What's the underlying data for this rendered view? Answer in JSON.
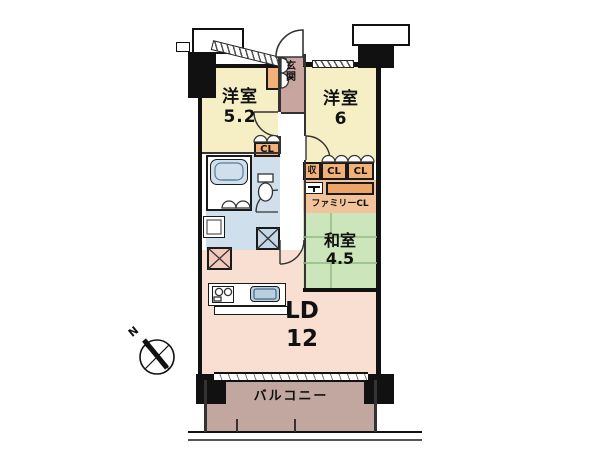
{
  "plan_title": "apartment-floor-plan",
  "compass": {
    "north_label": "N"
  },
  "rooms": {
    "bedroom1": {
      "label": "洋室",
      "size": "5.2"
    },
    "bedroom2": {
      "label": "洋室",
      "size": "6"
    },
    "entrance": {
      "label": "玄関"
    },
    "japanese_room": {
      "label": "和室",
      "size": "4.5"
    },
    "living_dining": {
      "label": "LD",
      "size": "12"
    },
    "balcony": {
      "label": "バルコニー"
    },
    "family_closet": {
      "label": "ファミリーCL"
    }
  },
  "closets": {
    "bedroom1_closet": "CL",
    "storage": "収",
    "hall_closet_a": "CL",
    "hall_closet_b": "CL"
  },
  "colors": {
    "wall": "#111111",
    "bedroom_yellow": "#f6efc6",
    "closet_orange": "#f2b176",
    "closet_orange_light": "#f3c49c",
    "entrance_mauve": "#c8a59e",
    "balcony_mauve": "#c2a6a0",
    "sanitary_blue": "#cfe0ec",
    "appliance_blue": "#c5d6e6",
    "living_pink": "#f9ded2",
    "fridge_pink": "#f2c9bc",
    "tatami_green": "#cde5bb",
    "tatami_line": "#94b983"
  }
}
